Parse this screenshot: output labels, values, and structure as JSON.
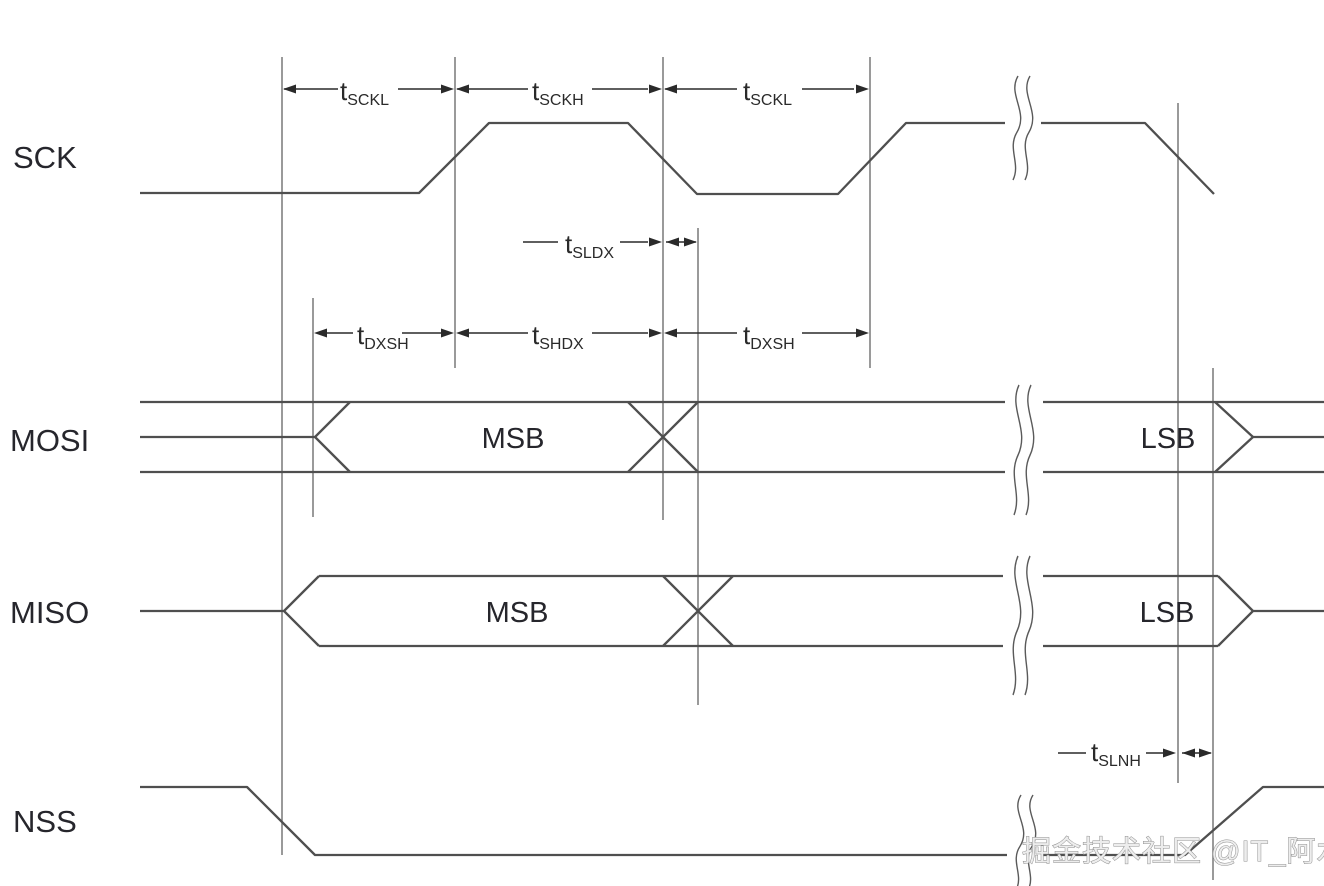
{
  "diagram": {
    "signals": {
      "sck": "SCK",
      "mosi": "MOSI",
      "miso": "MISO",
      "nss": "NSS"
    },
    "bus_labels": {
      "mosi_msb": "MSB",
      "mosi_lsb": "LSB",
      "miso_msb": "MSB",
      "miso_lsb": "LSB"
    },
    "timing": {
      "sckl1": {
        "base": "t",
        "sub": "SCKL"
      },
      "sckh": {
        "base": "t",
        "sub": "SCKH"
      },
      "sckl2": {
        "base": "t",
        "sub": "SCKL"
      },
      "sldx": {
        "base": "t",
        "sub": "SLDX"
      },
      "dxsh1": {
        "base": "t",
        "sub": "DXSH"
      },
      "shdx": {
        "base": "t",
        "sub": "SHDX"
      },
      "dxsh2": {
        "base": "t",
        "sub": "DXSH"
      },
      "slnh": {
        "base": "t",
        "sub": "SLNH"
      }
    },
    "watermark": "掘金技术社区 @IT_阿水",
    "colors": {
      "background": "#ffffff",
      "waveform": "#4f4f4f",
      "reference": "#6f6f6f",
      "dimension": "#2a2a2a",
      "label": "#26262c",
      "watermark_fill": "#ededed",
      "watermark_stroke": "#8f8f8f"
    }
  }
}
